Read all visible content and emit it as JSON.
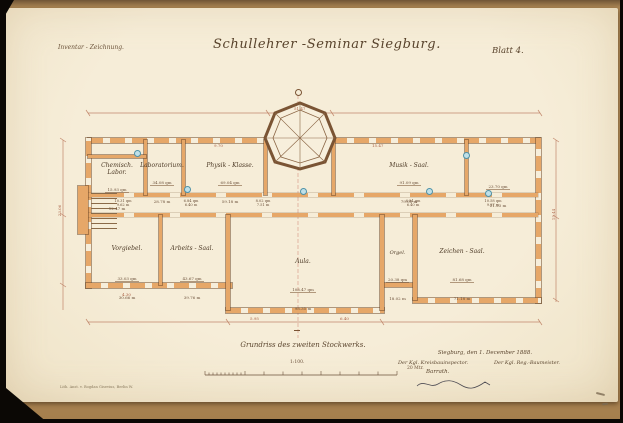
{
  "header": {
    "left_note": "Inventar - Zeichnung.",
    "title": "Schullehrer -Seminar Siegburg.",
    "sheet": "Blatt 4."
  },
  "rooms": [
    {
      "label": "Chemisch. Labor.",
      "area": "15.93 qm",
      "size": "12.47 m"
    },
    {
      "label": "Laboratorium.",
      "area": "34.08 qm",
      "size": "28.78 m"
    },
    {
      "label": "Physik - Klasse.",
      "area": "69.04 qm",
      "size": "59.18 m"
    },
    {
      "label": "Musik - Saal.",
      "area": "91.09 qm",
      "size": "79.05 m"
    },
    {
      "label": "",
      "area": "23.70 qm",
      "size": "21.23 m"
    },
    {
      "label": "Vorgiebel.",
      "area": "33.03 qm",
      "size": "30.66 m"
    },
    {
      "label": "Arbeits - Saal.",
      "area": "43.67 qm",
      "size": "39.76 m"
    },
    {
      "label": "Aula.",
      "area": "108.47 qm",
      "size": "98.35 m"
    },
    {
      "label": "Orgel.",
      "area": "20.38 qm",
      "size": "18.02 m"
    },
    {
      "label": "Zeichen - Saal.",
      "area": "81.68 qm",
      "size": "71.18 m"
    }
  ],
  "corridor": {
    "segments": [
      {
        "area": "10.31 qm",
        "size": "9.62 m"
      },
      {
        "area": "6.84 qm",
        "size": "6.40 m"
      },
      {
        "area": "8.02 qm",
        "size": "7.51 m"
      },
      {
        "area": "6.84 qm",
        "size": "6.40 m"
      },
      {
        "area": "10.58 qm",
        "size": "9.87 m"
      }
    ]
  },
  "dims": {
    "d0": "51.47",
    "d1": "15.47",
    "d2": "9.70",
    "d3": "4.30",
    "d4": "5.95",
    "d5": "6.40",
    "d6": "23.06",
    "d7": "15.44"
  },
  "caption": {
    "plan_title": "Grundriss des zweiten Stockwerks."
  },
  "scale": {
    "ratio": "1:100.",
    "unit_right": "20 Mtr."
  },
  "signature": {
    "place_date": "Siegburg, den 1. December 1888.",
    "left_title": "Der Kgl. Kreisbauinspector.",
    "right_title": "Der Kgl. Reg.-Baumeister.",
    "left_name": "Barrath."
  },
  "printer": "Lith. Anst. v. Bogdan Gisevius, Berlin W.",
  "colors": {
    "paper": "#f4ead3",
    "wall_fill": "#e6a768",
    "ink": "#4f3b27",
    "dimension_ink": "#a75d41",
    "stove_blue": "#4e92a8",
    "mount_tan": "#b08a58"
  }
}
